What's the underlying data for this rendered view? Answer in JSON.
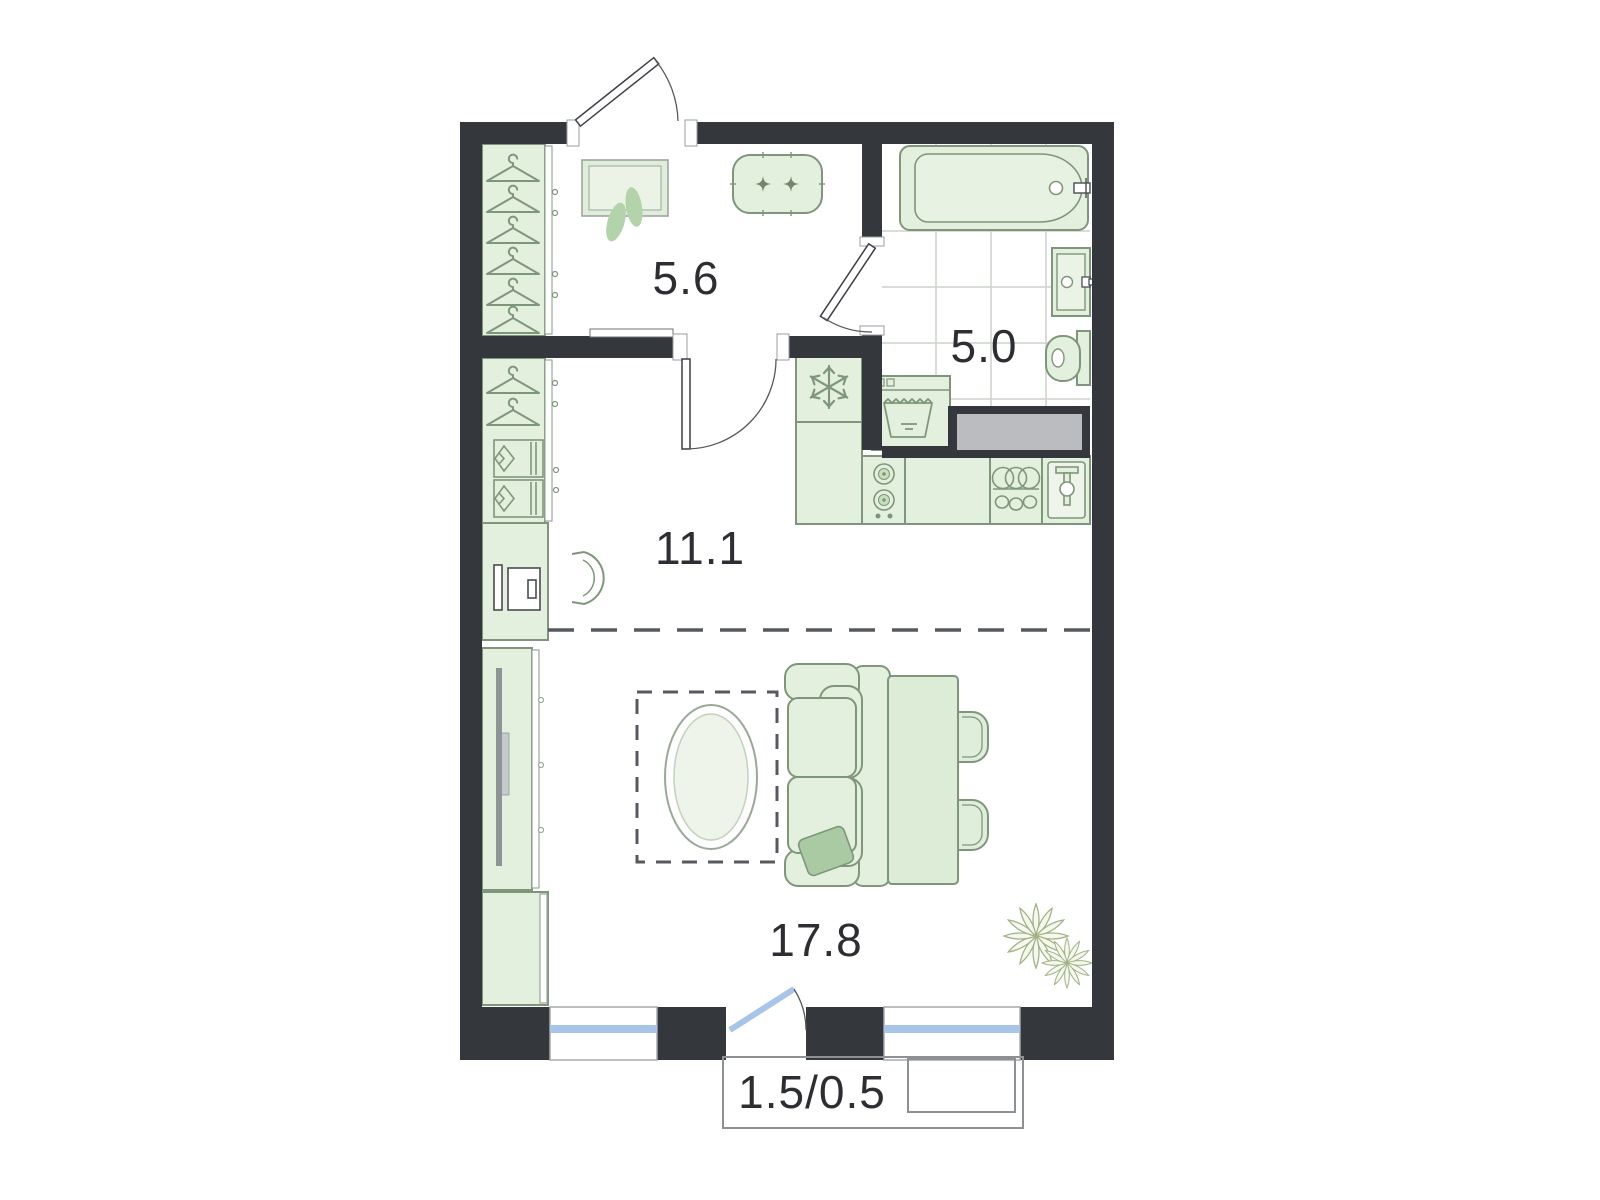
{
  "plan": {
    "type": "floor-plan",
    "unit": "studio-apartment",
    "rooms": [
      {
        "name": "hallway",
        "area": "5.6"
      },
      {
        "name": "bathroom",
        "area": "5.0"
      },
      {
        "name": "kitchen-zone",
        "area": "11.1"
      },
      {
        "name": "living-zone",
        "area": "17.8"
      },
      {
        "name": "balcony",
        "area": "1.5/0.5"
      }
    ],
    "colors": {
      "wall": "#34373c",
      "furniture_fill": "#e4f0de",
      "furniture_stroke": "#7f967b",
      "accent_leaf": "#b3d4ab",
      "pillow": "#a9caa3",
      "window_glass": "#a8c4e8",
      "duct_gray": "#babcbf",
      "tile_line": "#ccd2cc",
      "label_text": "#2c2e32"
    }
  }
}
